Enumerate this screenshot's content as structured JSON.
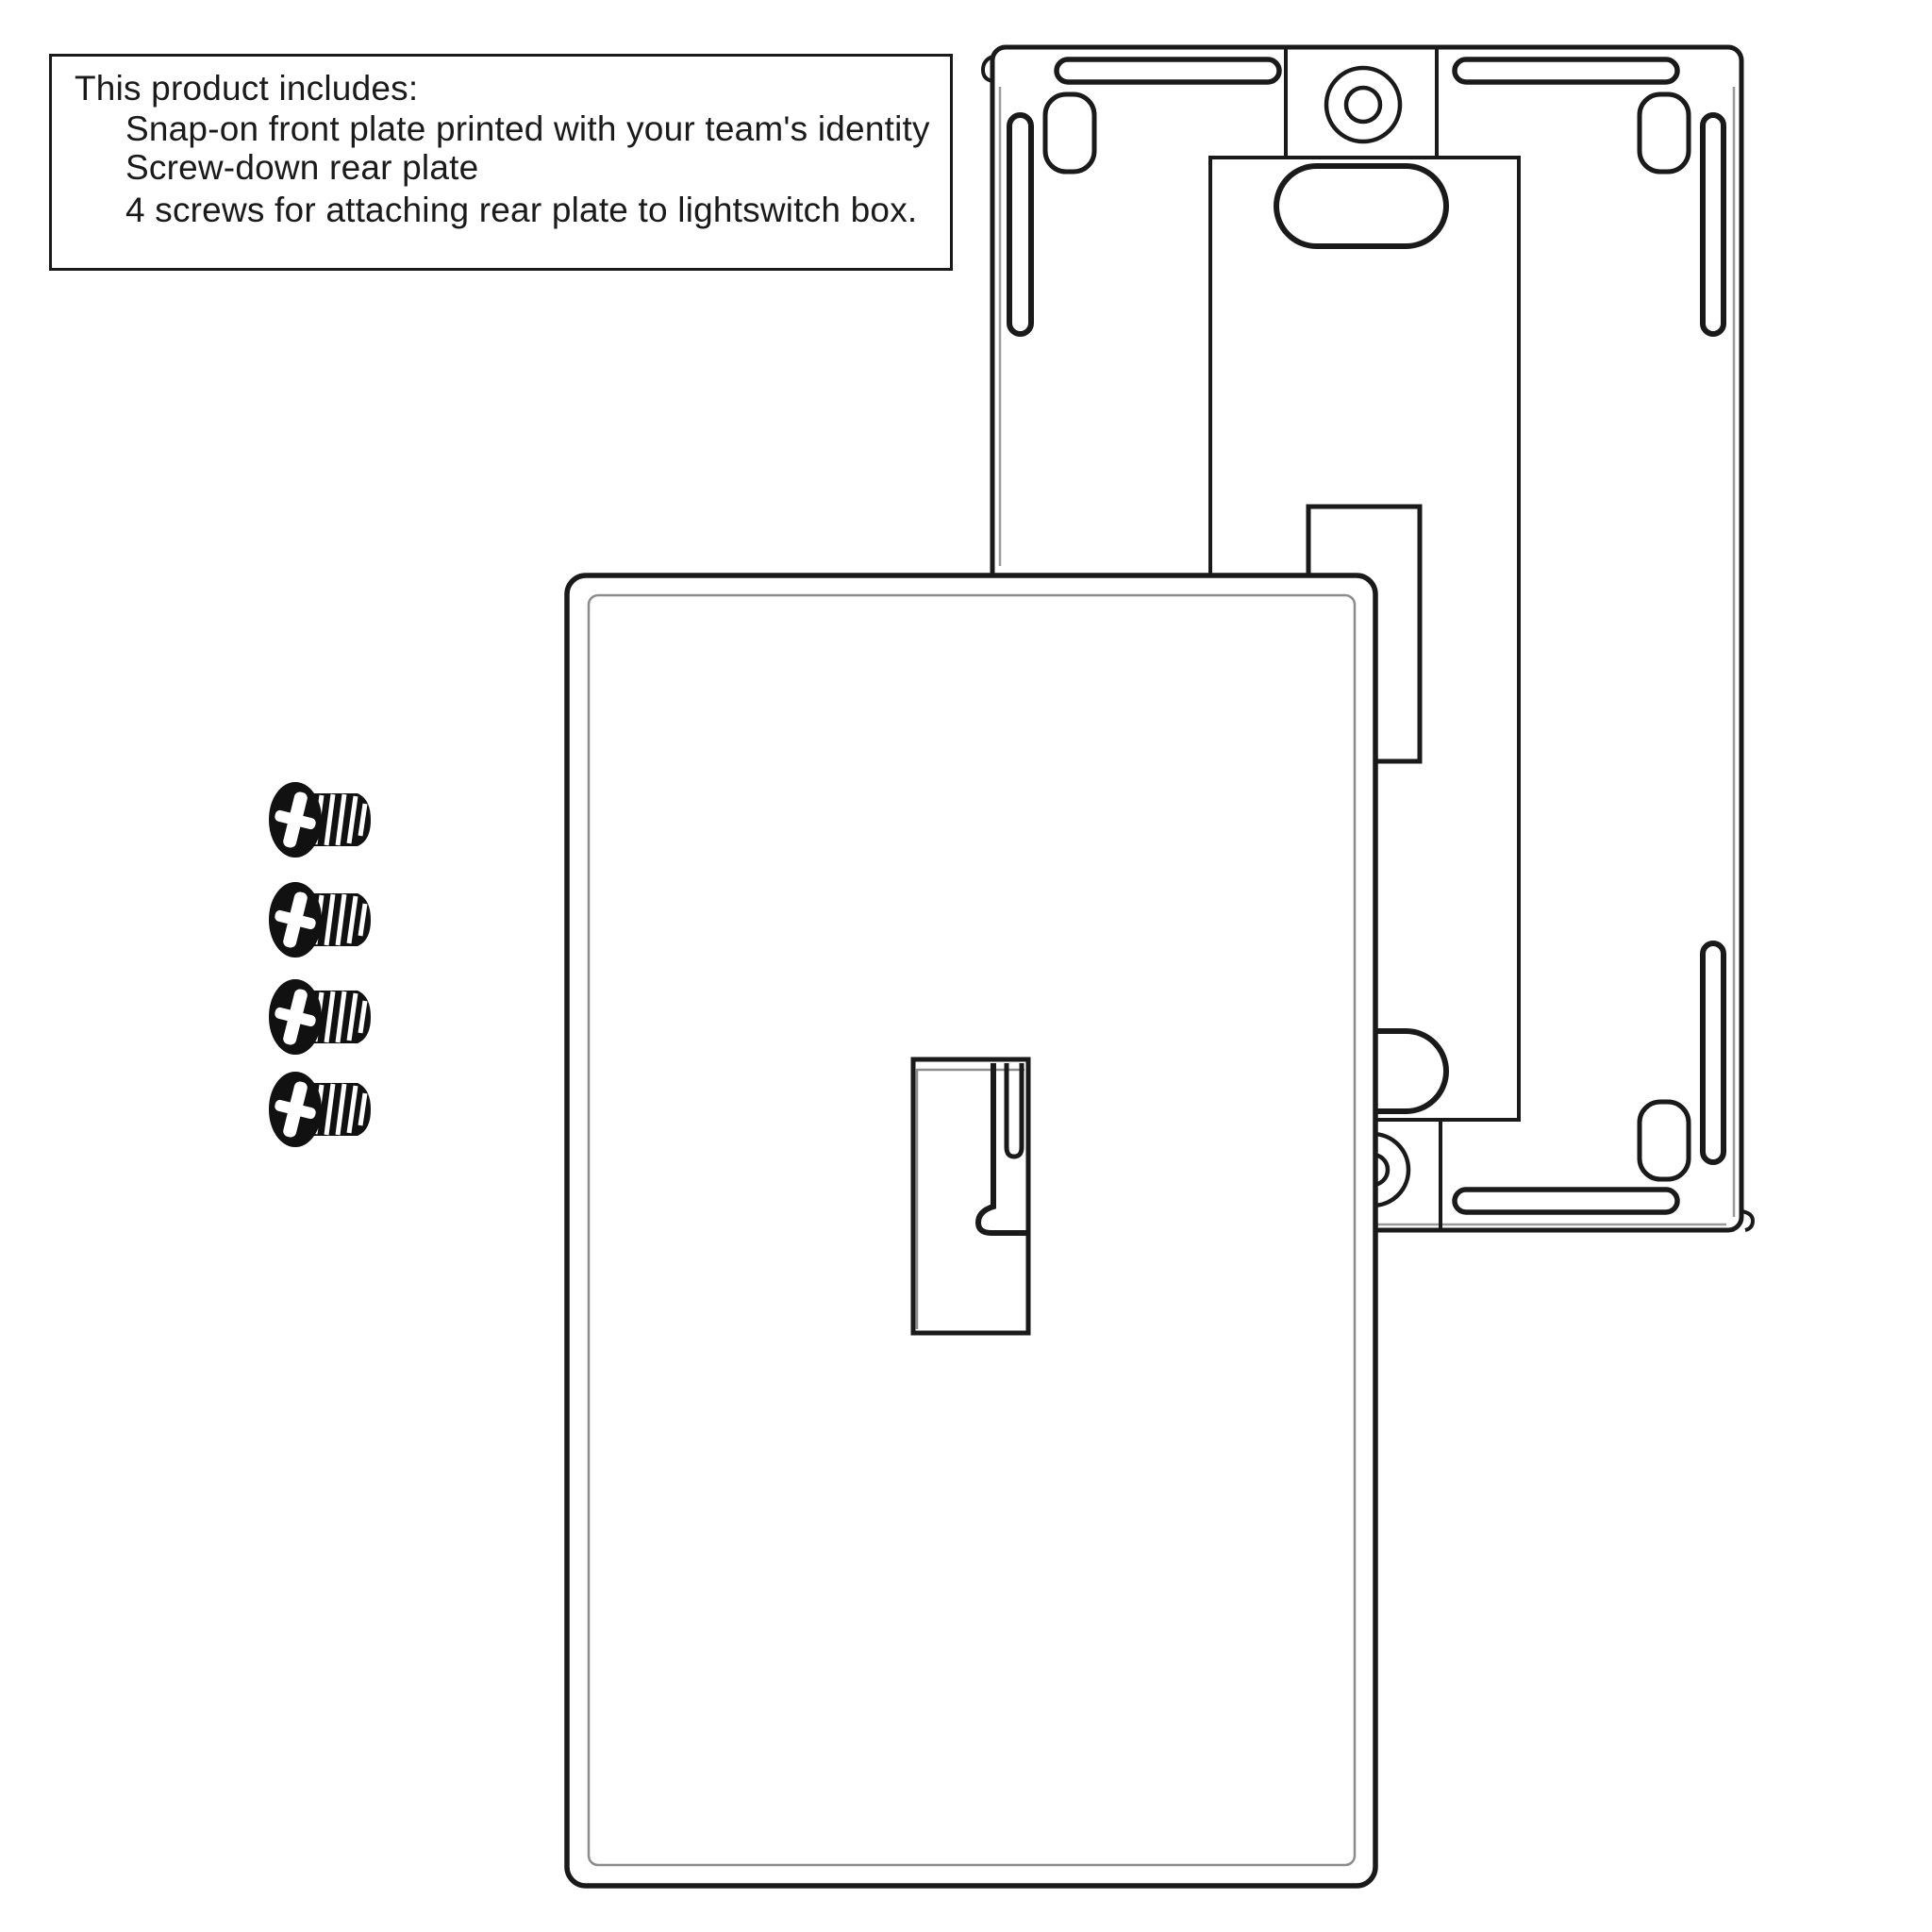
{
  "info_box": {
    "title": "This product includes:",
    "items": [
      "Snap-on front plate printed with your team's identity",
      "Screw-down rear plate",
      "4 screws for attaching rear plate to lightswitch box."
    ]
  },
  "diagram": {
    "screw_count": 4,
    "parts": {
      "rear_plate": "screw-down rear plate (back view)",
      "front_plate": "snap-on front plate with toggle opening",
      "screws": "mounting screws"
    },
    "colors": {
      "line": "#1a1a1a",
      "bevel": "#8c8c8c",
      "background": "#ffffff"
    }
  }
}
